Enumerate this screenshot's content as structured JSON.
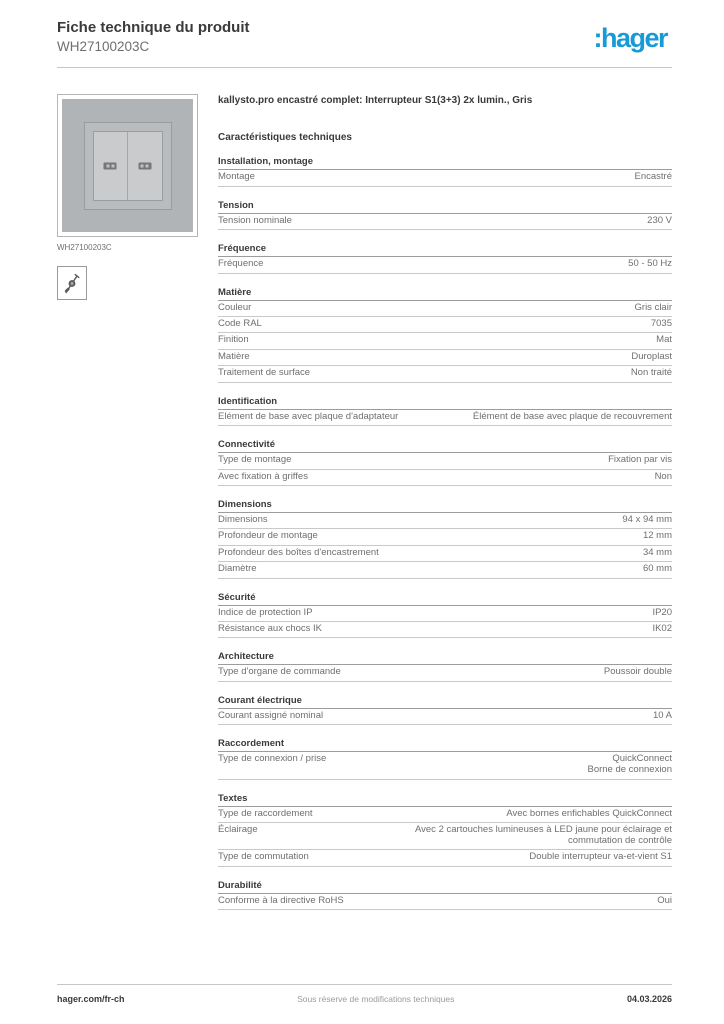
{
  "header": {
    "title": "Fiche technique du produit",
    "product_code": "WH27100203C",
    "logo_text": ":hager",
    "brand_color": "#189ad6"
  },
  "left": {
    "image_caption": "WH27100203C",
    "icons": {
      "tool": "screw-fixing-icon"
    }
  },
  "main": {
    "product_name": "kallysto.pro encastré complet: Interrupteur S1(3+3) 2x lumin., Gris",
    "section_title": "Caractéristiques techniques",
    "sections": [
      {
        "heading": "Installation, montage",
        "rows": [
          {
            "label": "Montage",
            "value": "Encastré"
          }
        ]
      },
      {
        "heading": "Tension",
        "rows": [
          {
            "label": "Tension nominale",
            "value": "230 V"
          }
        ]
      },
      {
        "heading": "Fréquence",
        "rows": [
          {
            "label": "Fréquence",
            "value": "50 - 50 Hz"
          }
        ]
      },
      {
        "heading": "Matière",
        "rows": [
          {
            "label": "Couleur",
            "value": "Gris clair"
          },
          {
            "label": "Code RAL",
            "value": "7035"
          },
          {
            "label": "Finition",
            "value": "Mat"
          },
          {
            "label": "Matière",
            "value": "Duroplast"
          },
          {
            "label": "Traitement de surface",
            "value": "Non traité"
          }
        ]
      },
      {
        "heading": "Identification",
        "rows": [
          {
            "label": "Elément de base avec plaque d'adaptateur",
            "value": "Élément de base avec plaque de recouvrement"
          }
        ]
      },
      {
        "heading": "Connectivité",
        "rows": [
          {
            "label": "Type de montage",
            "value": "Fixation par vis"
          },
          {
            "label": "Avec fixation à griffes",
            "value": "Non"
          }
        ]
      },
      {
        "heading": "Dimensions",
        "rows": [
          {
            "label": "Dimensions",
            "value": "94 x 94 mm"
          },
          {
            "label": "Profondeur de montage",
            "value": "12 mm"
          },
          {
            "label": "Profondeur des boîtes d'encastrement",
            "value": "34 mm"
          },
          {
            "label": "Diamètre",
            "value": "60 mm"
          }
        ]
      },
      {
        "heading": "Sécurité",
        "rows": [
          {
            "label": "Indice de protection IP",
            "value": "IP20"
          },
          {
            "label": "Résistance aux chocs IK",
            "value": "IK02"
          }
        ]
      },
      {
        "heading": "Architecture",
        "rows": [
          {
            "label": "Type d'organe de commande",
            "value": "Poussoir double"
          }
        ]
      },
      {
        "heading": "Courant électrique",
        "rows": [
          {
            "label": "Courant assigné nominal",
            "value": "10 A"
          }
        ]
      },
      {
        "heading": "Raccordement",
        "rows": [
          {
            "label": "Type de connexion / prise",
            "value": "QuickConnect\nBorne de connexion"
          }
        ]
      },
      {
        "heading": "Textes",
        "rows": [
          {
            "label": "Type de raccordement",
            "value": "Avec bornes enfichables QuickConnect"
          },
          {
            "label": "Éclairage",
            "value": "Avec 2 cartouches lumineuses à LED jaune pour éclairage et\ncommutation de contrôle"
          },
          {
            "label": "Type de commutation",
            "value": "Double interrupteur va-et-vient S1"
          }
        ]
      },
      {
        "heading": "Durabilité",
        "rows": [
          {
            "label": "Conforme à la directive RoHS",
            "value": "Oui"
          }
        ]
      }
    ]
  },
  "footer": {
    "website": "hager.com/fr-ch",
    "disclaimer": "Sous réserve de modifications techniques",
    "date": "04.03.2026"
  }
}
